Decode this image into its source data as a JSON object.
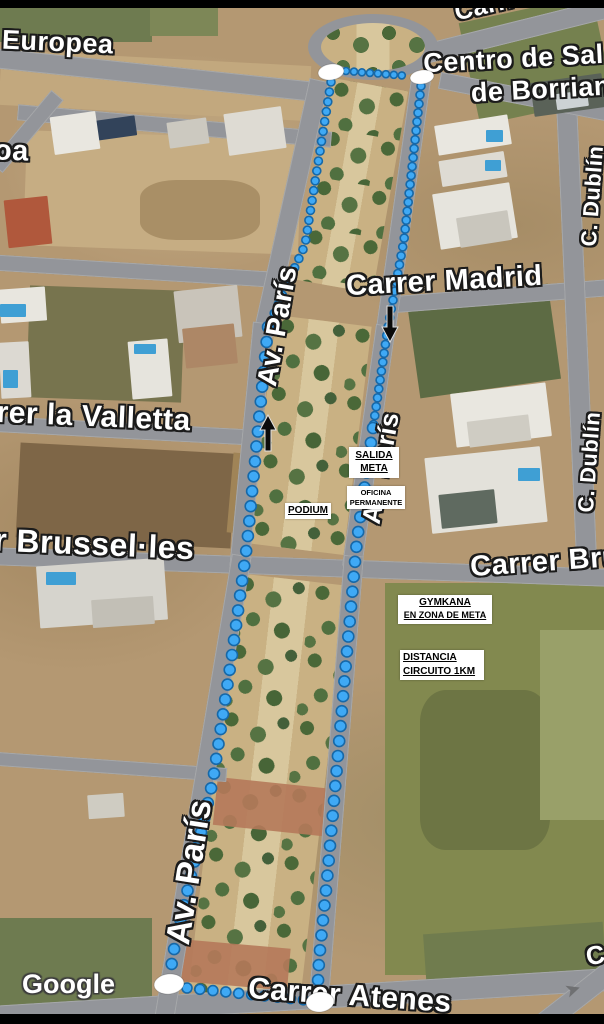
{
  "map": {
    "attribution": "Google",
    "streets": {
      "europea": "Europea",
      "lisboa_fragment": "oa",
      "carr_del": "Carr. del",
      "centro_salut_line1": "Centro de Sal",
      "centro_salut_line2": "de Borriana",
      "carrer_madrid": "Carrer Madrid",
      "carrer_la_valletta": "Carrer la Valletta",
      "carrer_brusselles": "Carrer Brussel·les",
      "av_paris": "Av. París",
      "c_dublin": "C. Dublín",
      "carrer_atenes": "Carrer Atenes",
      "c_fragment": "C"
    }
  },
  "annotations": {
    "salida_meta": {
      "line1": "SALIDA",
      "line2": "META"
    },
    "oficina": {
      "line1": "OFICINA",
      "line2": "PERMANENTE"
    },
    "podium": {
      "label": "PODIUM"
    },
    "gymkana": {
      "line1": "GYMKANA",
      "line2": "EN ZONA DE META"
    },
    "distancia": {
      "line1": "DISTANCIA",
      "line2": "CIRCUITO 1KM"
    }
  },
  "route": {
    "dot_fill": "#3FA9F5",
    "dot_stroke": "#1668A8",
    "marker_fill": "#FFFFFF",
    "arrow_color": "#0B0B0B",
    "segments": [
      {
        "name": "top-connector",
        "spacing": 8,
        "r": 3.5,
        "points": [
          [
            346,
            71
          ],
          [
            409,
            76
          ]
        ]
      },
      {
        "name": "west-line-upper",
        "spacing": 10,
        "r": 4,
        "points": [
          [
            331,
            82
          ],
          [
            305,
            245
          ],
          [
            268,
            327
          ]
        ]
      },
      {
        "name": "west-line-lower",
        "spacing": 15,
        "r": 5.5,
        "points": [
          [
            268,
            327
          ],
          [
            258,
            430
          ],
          [
            247,
            545
          ],
          [
            232,
            655
          ],
          [
            213,
            780
          ],
          [
            193,
            868
          ],
          [
            176,
            938
          ],
          [
            171,
            968
          ]
        ]
      },
      {
        "name": "east-line-upper",
        "spacing": 9,
        "r": 4,
        "points": [
          [
            421,
            86
          ],
          [
            404,
            240
          ],
          [
            388,
            327
          ],
          [
            373,
            428
          ]
        ]
      },
      {
        "name": "east-line-lower",
        "spacing": 15,
        "r": 5.5,
        "points": [
          [
            373,
            428
          ],
          [
            357,
            540
          ],
          [
            348,
            640
          ],
          [
            338,
            755
          ],
          [
            327,
            880
          ],
          [
            319,
            960
          ],
          [
            318,
            983
          ]
        ]
      },
      {
        "name": "bottom-connector",
        "spacing": 13,
        "r": 5,
        "points": [
          [
            187,
            988
          ],
          [
            305,
            1000
          ]
        ]
      }
    ],
    "markers": [
      {
        "cx": 331,
        "cy": 72,
        "rx": 13,
        "ry": 8,
        "tilt": -8
      },
      {
        "cx": 422,
        "cy": 77,
        "rx": 12,
        "ry": 7,
        "tilt": -8
      },
      {
        "cx": 169,
        "cy": 984,
        "rx": 15,
        "ry": 10,
        "tilt": -6
      },
      {
        "cx": 320,
        "cy": 1002,
        "rx": 14,
        "ry": 10,
        "tilt": -6
      }
    ],
    "arrows": [
      {
        "x": 268,
        "y": 433,
        "dir": "up"
      },
      {
        "x": 390,
        "y": 324,
        "dir": "down"
      }
    ]
  }
}
